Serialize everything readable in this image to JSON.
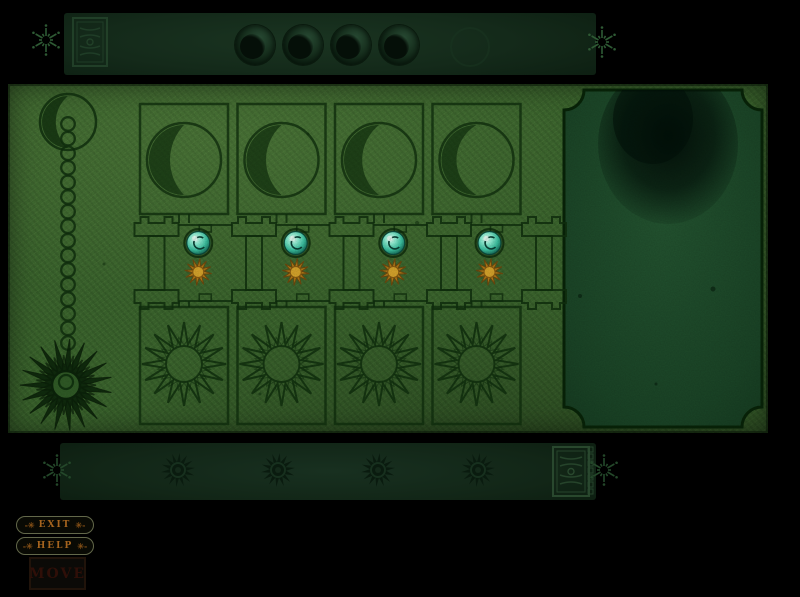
{
  "screen": {
    "name": "alchemy-dial-puzzle"
  },
  "top_bar": {
    "seal": {
      "icon": "ornate-seal-stamp"
    },
    "moon_dials": [
      {
        "id": "moon-dial-1",
        "icon": "crescent-moon-knob"
      },
      {
        "id": "moon-dial-2",
        "icon": "crescent-moon-knob"
      },
      {
        "id": "moon-dial-3",
        "icon": "crescent-moon-knob"
      },
      {
        "id": "moon-dial-4",
        "icon": "crescent-moon-knob"
      }
    ],
    "ghost_dial": {
      "id": "moon-dial-5-faint",
      "icon": "crescent-moon-knob-faint"
    },
    "sparkles": [
      "sparkle-left",
      "sparkle-right"
    ]
  },
  "board": {
    "left_ornament": {
      "icon": "moon-chain-sun-pendulum",
      "chain_links": 16
    },
    "columns": [
      {
        "id": 1,
        "top_symbol": "crescent-moon-engraving",
        "bottom_symbol": "sun-engraving",
        "moon_gem_color": "#7fe9cb",
        "sun_gem_color": "#c08427"
      },
      {
        "id": 2,
        "top_symbol": "crescent-moon-engraving",
        "bottom_symbol": "sun-engraving",
        "moon_gem_color": "#7fe9cb",
        "sun_gem_color": "#c08427"
      },
      {
        "id": 3,
        "top_symbol": "crescent-moon-engraving",
        "bottom_symbol": "sun-engraving",
        "moon_gem_color": "#7fe9cb",
        "sun_gem_color": "#c08427"
      },
      {
        "id": 4,
        "top_symbol": "crescent-moon-engraving",
        "bottom_symbol": "sun-engraving",
        "moon_gem_color": "#7fe9cb",
        "sun_gem_color": "#c08427"
      }
    ],
    "right_panel": {
      "icon": "vision-panel",
      "detail": "faint-dark-figure"
    }
  },
  "bottom_bar": {
    "sun_dials": [
      {
        "id": "sun-dial-1",
        "icon": "sun-gear"
      },
      {
        "id": "sun-dial-2",
        "icon": "sun-gear"
      },
      {
        "id": "sun-dial-3",
        "icon": "sun-gear"
      },
      {
        "id": "sun-dial-4",
        "icon": "sun-gear"
      }
    ],
    "seal": {
      "icon": "ornate-seal-stamp"
    },
    "sparkles": [
      "sparkle-left",
      "sparkle-right"
    ]
  },
  "buttons": {
    "exit": {
      "label": "EXIT",
      "prefix": "-✳",
      "suffix": "✳-"
    },
    "help": {
      "label": "HELP",
      "prefix": "-✳",
      "suffix": "✳-"
    },
    "move": {
      "label": "MOVE"
    }
  },
  "colors": {
    "board_green": "#3c672e",
    "panel_green": "#1f4e2e",
    "bar_green": "#142a1a",
    "engraving_ink": "#10300e",
    "gem_cyan": "#7fe9cb",
    "gem_orange": "#c08427",
    "button_text": "#a5641e"
  }
}
